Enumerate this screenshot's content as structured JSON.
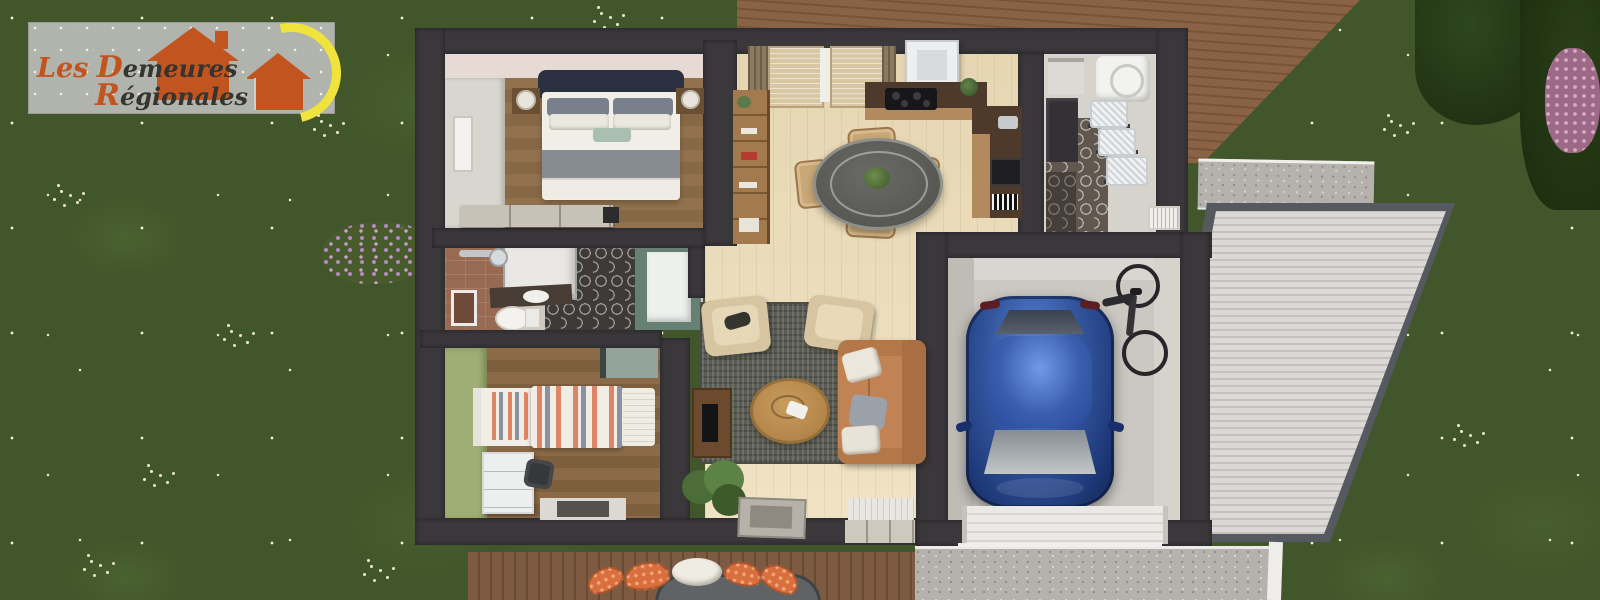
{
  "scene": {
    "title": "Aerial 3D rendering of a single-storey house floor plan",
    "environment": [
      "lawn with white flower clusters",
      "top wooden terrace",
      "front wooden terrace with outdoor cushions",
      "gravel driveway",
      "corrugated carport roof",
      "trees and pink flowering shrubs"
    ]
  },
  "logo": {
    "word1": "Les",
    "word2_initial": "D",
    "word2_rest": "emeures",
    "word3_initial": "R",
    "word3_rest": "égionales",
    "colors": {
      "accent": "#c2551f",
      "text": "#36342f",
      "sun": "#f0e43c",
      "panel": "#b4b5af"
    }
  },
  "palette": {
    "grass": "#41562a",
    "house_wall": "#3a383b",
    "bedroom_floor": "#8f6f4c",
    "living_floor": "#e9dab8",
    "rug": "#5b5d55",
    "sofa": "#c28354",
    "armchair": "#d6c5a0",
    "car": "#2c4f9e",
    "deck": "#8a6246",
    "carport_roof": "#d6d2d0",
    "gravel": "#b5b1ad",
    "hex_tile": "#3e3a39",
    "terracotta_wall": "#996a52",
    "olive_wall": "#9fae74",
    "teal_unit": "#678074",
    "kitchen_counter": "#4e3a2a",
    "garage_floor": "#cbc7c1",
    "bed_stripe": "#e08467"
  },
  "rooms": [
    {
      "id": "master-bedroom",
      "items": [
        "double-bed",
        "nightstands-with-lamps",
        "wardrobe",
        "dresser"
      ]
    },
    {
      "id": "bathroom",
      "items": [
        "shower",
        "toilet",
        "vanity-sink",
        "teal-unit"
      ]
    },
    {
      "id": "second-bedroom",
      "items": [
        "single-bed-striped",
        "desk",
        "chair",
        "floor-mat"
      ]
    },
    {
      "id": "living-dining-room",
      "items": [
        "window-curtains",
        "bookshelf",
        "round-dining-table",
        "four-chairs",
        "l-shaped-kitchen",
        "range-hood",
        "rug",
        "two-armchairs",
        "coffee-table",
        "sofa",
        "tv-unit",
        "plant",
        "doormats"
      ]
    },
    {
      "id": "laundry-room",
      "items": [
        "washing-machine",
        "storage-baskets",
        "wall-heater",
        "hex-tile-floor"
      ]
    },
    {
      "id": "garage",
      "items": [
        "blue-car",
        "bicycle",
        "garage-door"
      ]
    }
  ]
}
